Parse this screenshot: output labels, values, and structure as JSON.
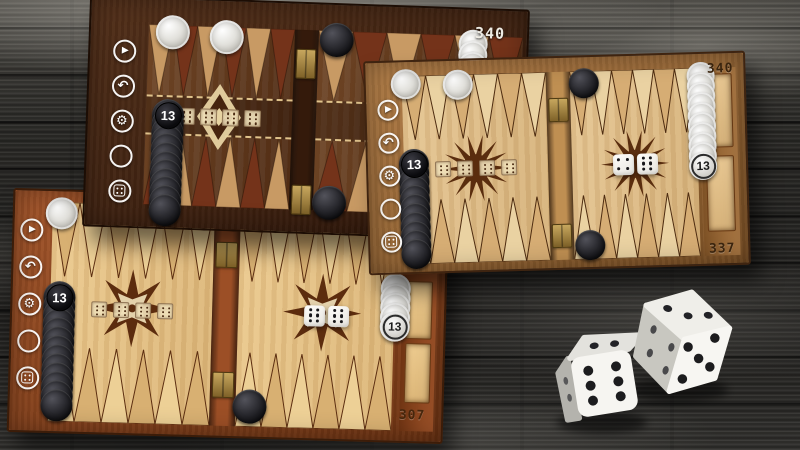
{
  "background": {
    "plank_base": "#2c2b28",
    "plank_dark": "#1c1b19",
    "plank_light": "#8e8c86",
    "seam": "#0d0d0c"
  },
  "sidebar": [
    {
      "id": "play"
    },
    {
      "id": "undo"
    },
    {
      "id": "settings"
    },
    {
      "id": "moves"
    },
    {
      "id": "dice"
    }
  ],
  "checker_colors": {
    "white": "#e8e7e2",
    "black": "#17171b"
  },
  "boards": [
    {
      "id": "walnut",
      "label": "dark walnut board",
      "score_top": "340",
      "engraved_dice": [
        6,
        6,
        6,
        6
      ],
      "rolled_dice": [],
      "theme": {
        "frame": "#53301a",
        "frame_dark": "#2f170a",
        "border": "#1c0d04",
        "field": "#6e4526",
        "field_dark": "#4e2b14",
        "point_a": "#c89a64",
        "point_b": "#74331a",
        "outline": "rgba(25,10,3,0.4)",
        "bar": "#341a0b",
        "stitch": "#e0c38c",
        "ornament": "#e7d3a2",
        "score": "#efece4"
      },
      "stacks": [
        {
          "x": 82,
          "y": 33,
          "count": 1,
          "color": "white",
          "d": 34
        },
        {
          "x": 136,
          "y": 36,
          "count": 1,
          "color": "white",
          "d": 34
        },
        {
          "x": 246,
          "y": 35,
          "count": 1,
          "color": "black",
          "d": 34
        },
        {
          "x": 80,
          "y": 116,
          "count": 12,
          "step": 8.6,
          "color": "black",
          "d": 32,
          "badge": "13",
          "badge_at": "start"
        },
        {
          "x": 382,
          "y": 34,
          "count": 4,
          "step": 11,
          "color": "white",
          "d": 29
        },
        {
          "x": 244,
          "y": 198,
          "count": 1,
          "color": "black",
          "d": 34
        }
      ]
    },
    {
      "id": "oak",
      "label": "light oak board",
      "score_top": "340",
      "score_bottom": "337",
      "engraved_dice": [
        6,
        6,
        6,
        6
      ],
      "rolled_dice": [
        4,
        6
      ],
      "theme": {
        "frame": "#b07c46",
        "frame_dark": "#7e5226",
        "border": "#3f2410",
        "field": "#e6c692",
        "field_dark": "#d6b27a",
        "point_a": "#d6ad74",
        "point_b": "#ead2a2",
        "outline": "#4e2c10",
        "bar": "#bf8f52",
        "stitch": null,
        "ornament": "#5a2d0e",
        "score": "#3a240e",
        "tray": "#e9c893",
        "tray_border": "#6b3c16"
      },
      "stacks": [
        {
          "x": 40,
          "y": 22,
          "count": 1,
          "color": "white",
          "d": 30
        },
        {
          "x": 92,
          "y": 24,
          "count": 1,
          "color": "white",
          "d": 30
        },
        {
          "x": 46,
          "y": 102,
          "count": 11,
          "step": 9,
          "color": "black",
          "d": 30,
          "badge": "13",
          "badge_at": "start"
        },
        {
          "x": 218,
          "y": 26,
          "count": 1,
          "color": "black",
          "d": 30
        },
        {
          "x": 220,
          "y": 188,
          "count": 1,
          "color": "black",
          "d": 30
        },
        {
          "x": 335,
          "y": 22,
          "count": 10,
          "step": 10,
          "color": "white",
          "d": 28,
          "badge": "13",
          "badge_at": "end"
        }
      ]
    },
    {
      "id": "mahogany",
      "label": "red mahogany board",
      "score_bottom": "307",
      "engraved_dice": [
        6,
        6,
        6,
        6
      ],
      "rolled_dice": [
        6,
        6
      ],
      "theme": {
        "frame": "#a3552a",
        "frame_dark": "#6f3413",
        "border": "#3c1c08",
        "field": "#ecca8e",
        "field_dark": "#dcb678",
        "point_a": "#d8b072",
        "point_b": "#edd096",
        "outline": "#5c2e10",
        "bar": "#9c4f26",
        "stitch": null,
        "ornament": "#5c2c0e",
        "score": "#46260c",
        "tray": "#ecca8e",
        "tray_border": "#6b3c16"
      },
      "stacks": [
        {
          "x": 47,
          "y": 22,
          "count": 1,
          "color": "white",
          "d": 32
        },
        {
          "x": 47,
          "y": 106,
          "count": 13,
          "step": 9,
          "color": "black",
          "d": 32,
          "badge": "13",
          "badge_at": "start"
        },
        {
          "x": 240,
          "y": 210,
          "count": 1,
          "color": "black",
          "d": 34
        },
        {
          "x": 383,
          "y": 88,
          "count": 5,
          "step": 9.5,
          "color": "white",
          "d": 30,
          "badge": "13",
          "badge_at": "end"
        }
      ]
    }
  ],
  "photo_dice": {
    "left_die_faces": {
      "front": 6,
      "top": 2
    },
    "right_die_faces": {
      "top": 3,
      "right": 5,
      "left": 4
    }
  }
}
